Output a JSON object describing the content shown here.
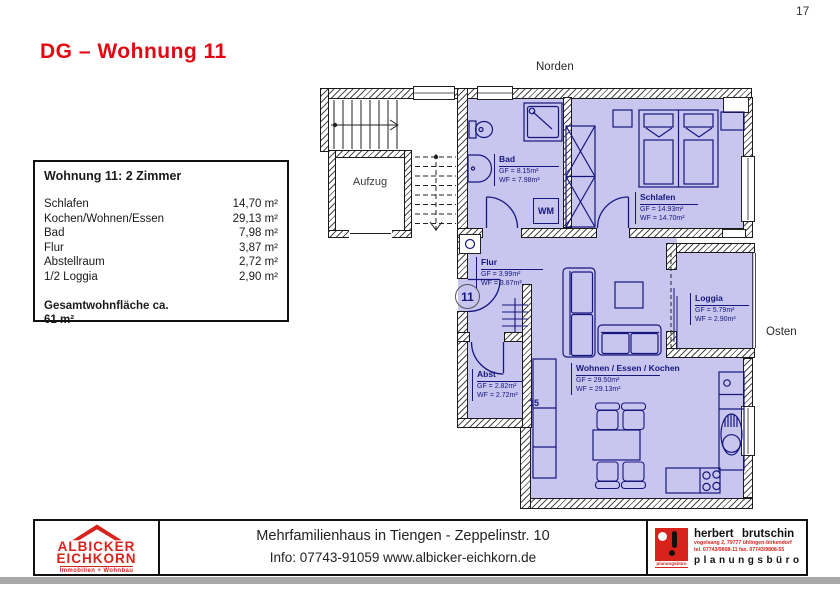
{
  "page_number": "17",
  "title": "DG – Wohnung 11",
  "compass": {
    "north": "Norden",
    "east": "Osten"
  },
  "info_box": {
    "title": "Wohnung 11: 2 Zimmer",
    "rows": [
      {
        "label": "Schlafen",
        "value": "14,70 m²"
      },
      {
        "label": "Kochen/Wohnen/Essen",
        "value": "29,13 m²"
      },
      {
        "label": "Bad",
        "value": "7,98 m²"
      },
      {
        "label": "Flur",
        "value": "3,87 m²"
      },
      {
        "label": "Abstellraum",
        "value": "2,72 m²"
      },
      {
        "label": "1/2 Loggia",
        "value": "2,90 m²"
      }
    ],
    "total_label": "Gesamtwohnfläche ca.",
    "total_value": "61 m²"
  },
  "plan": {
    "aufzug_label": "Aufzug",
    "apartment_number": "11",
    "wm_label": "WM",
    "steps_label": "15",
    "rooms": [
      {
        "name": "Bad",
        "gf": "GF = 8.15m²",
        "wf": "WF = 7.98m²"
      },
      {
        "name": "Schlafen",
        "gf": "GF = 14.93m²",
        "wf": "WF = 14.70m²"
      },
      {
        "name": "Flur",
        "gf": "GF = 3.99m²",
        "wf": "WF = 3.87m²"
      },
      {
        "name": "Abst",
        "gf": "GF = 2.82m²",
        "wf": "WF = 2.72m²"
      },
      {
        "name": "Wohnen / Essen / Kochen",
        "gf": "GF = 29.50m²",
        "wf": "WF = 29.13m²"
      },
      {
        "name": "Loggia",
        "gf": "GF = 5.79m²",
        "wf": "WF = 2.90m²"
      }
    ]
  },
  "footer": {
    "albicker": {
      "line1": "ALBICKER",
      "line2": "EICHKORN",
      "subtitle": "Immobilien + Wohnbau"
    },
    "project": "Mehrfamilienhaus in Tiengen - Zeppelinstr. 10",
    "info": "Info: 07743-91059 www.albicker-eichkorn.de",
    "brutschin": {
      "name": "herbert brutschin",
      "address": "vogelsang 2, 79777 ühlingen-birkendorf",
      "phone": "tel. 07743/9808-11  fax. 07743/9808-55",
      "type": "planungsbüro",
      "logo_text": "planungsbüro"
    }
  },
  "colors": {
    "accent_red": "#e30613",
    "logo_red": "#d8231d",
    "room_fill": "#c8c6ef",
    "plan_line": "#16167e"
  }
}
